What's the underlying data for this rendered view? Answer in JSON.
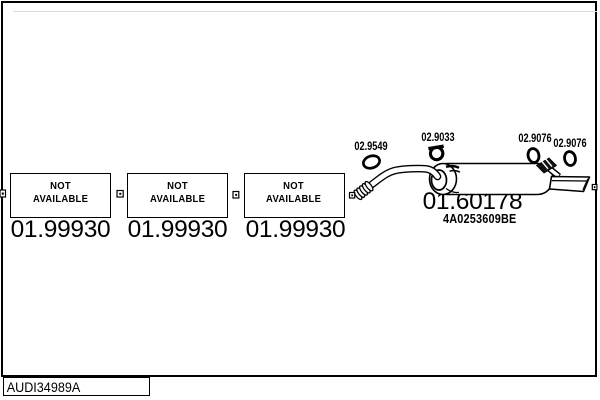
{
  "frame": {
    "catalog_code": "AUDI34989A"
  },
  "placeholders": [
    {
      "line1": "NOT",
      "line2": "AVAILABLE",
      "part_number": "01.99930"
    },
    {
      "line1": "NOT",
      "line2": "AVAILABLE",
      "part_number": "01.99930"
    },
    {
      "line1": "NOT",
      "line2": "AVAILABLE",
      "part_number": "01.99930"
    }
  ],
  "clamps": [
    {
      "label": "02.9549"
    },
    {
      "label": "02.9033"
    },
    {
      "label": "02.9076"
    },
    {
      "label": "02.9076"
    }
  ],
  "muffler": {
    "part_number": "01.60178",
    "oem_reference": "4A0253609BE"
  },
  "colors": {
    "line": "#000000",
    "background": "#ffffff"
  }
}
